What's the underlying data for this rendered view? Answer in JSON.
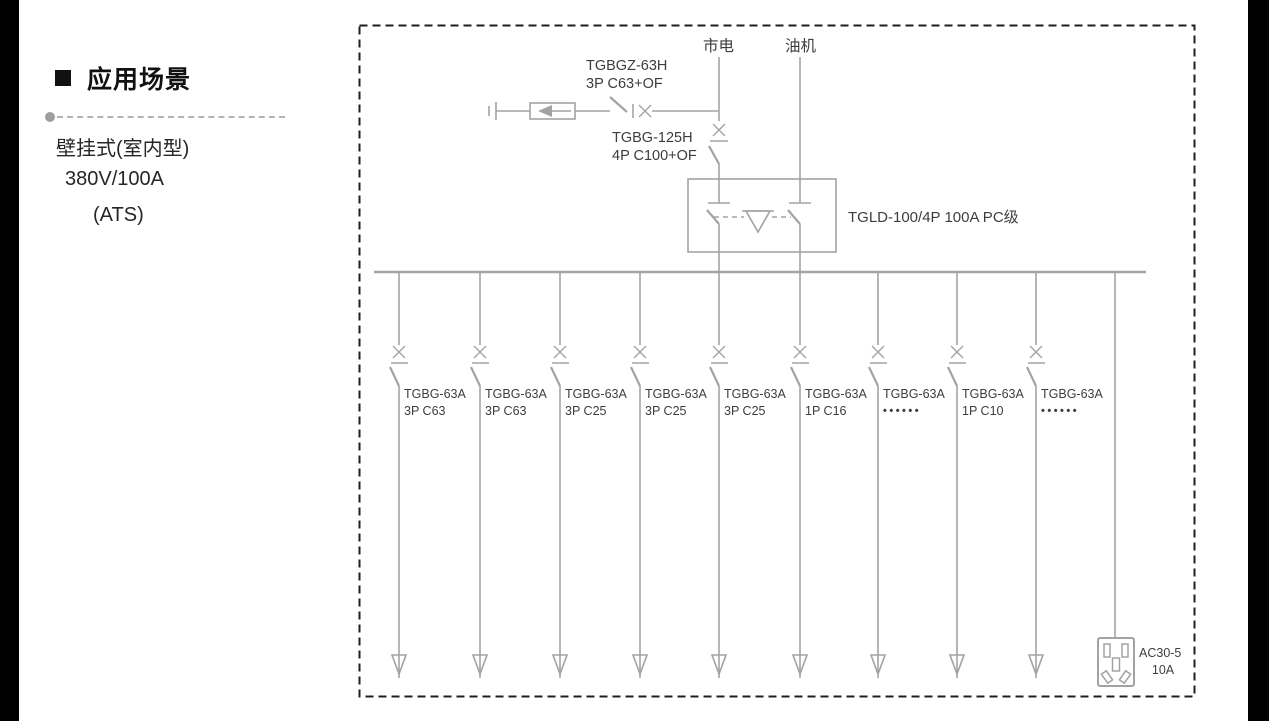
{
  "sidebar": {
    "title": "应用场景",
    "lines": [
      "壁挂式(室内型)",
      "380V/100A",
      "(ATS)"
    ]
  },
  "diagram": {
    "mains_label": "市电",
    "generator_label": "油机",
    "spd_breaker": {
      "model": "TGBGZ-63H",
      "spec": "3P C63+OF"
    },
    "main_breaker": {
      "model": "TGBG-125H",
      "spec": "4P C100+OF"
    },
    "ats_label": "TGLD-100/4P 100A PC级",
    "branches": [
      {
        "model": "TGBG-63A",
        "spec": "3P C63"
      },
      {
        "model": "TGBG-63A",
        "spec": "3P C63"
      },
      {
        "model": "TGBG-63A",
        "spec": "3P C25"
      },
      {
        "model": "TGBG-63A",
        "spec": "3P C25"
      },
      {
        "model": "TGBG-63A",
        "spec": "3P C25"
      },
      {
        "model": "TGBG-63A",
        "spec": "1P C16"
      },
      {
        "model": "TGBG-63A",
        "spec": "••••••"
      },
      {
        "model": "TGBG-63A",
        "spec": "1P C10"
      },
      {
        "model": "TGBG-63A",
        "spec": "••••••"
      }
    ],
    "socket": {
      "model": "AC30-5",
      "rating": "10A"
    }
  },
  "colors": {
    "line": "#a3a3a3",
    "text": "#3d3d3d",
    "border": "#1f1f1f",
    "side_bars": "#000000"
  }
}
